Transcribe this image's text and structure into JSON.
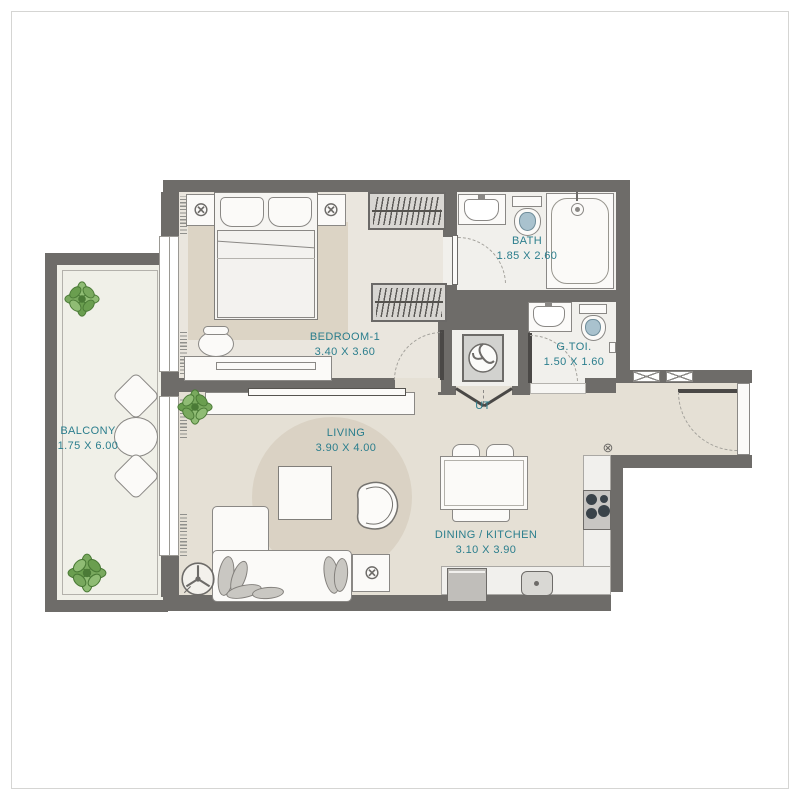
{
  "plan": {
    "type": "apartment-floor-plan",
    "accent_color": "#2b7e8d",
    "wall_color": "#6e6c69",
    "floor_colors": {
      "living_dining": "#e5e0d5",
      "bedroom": "#eae6de",
      "bath": "#f1f0ec",
      "balcony": "#f0f0e8",
      "rug": "#dcd4c5"
    },
    "rooms": {
      "balcony": {
        "name": "BALCONY",
        "dims": "1.75 X 6.00"
      },
      "bedroom": {
        "name": "BEDROOM-1",
        "dims": "3.40 X 3.60"
      },
      "bath": {
        "name": "BATH",
        "dims": "1.85 X 2.60"
      },
      "gtoi": {
        "name": "G.TOI.",
        "dims": "1.50 X 1.60"
      },
      "ut": {
        "name": "UT"
      },
      "living": {
        "name": "LIVING",
        "dims": "3.90 X 4.00"
      },
      "dining": {
        "name": "DINING / KITCHEN",
        "dims": "3.10 X 3.90"
      }
    },
    "icons": {
      "lamp": "⊗",
      "gas_point": "⊗"
    }
  }
}
